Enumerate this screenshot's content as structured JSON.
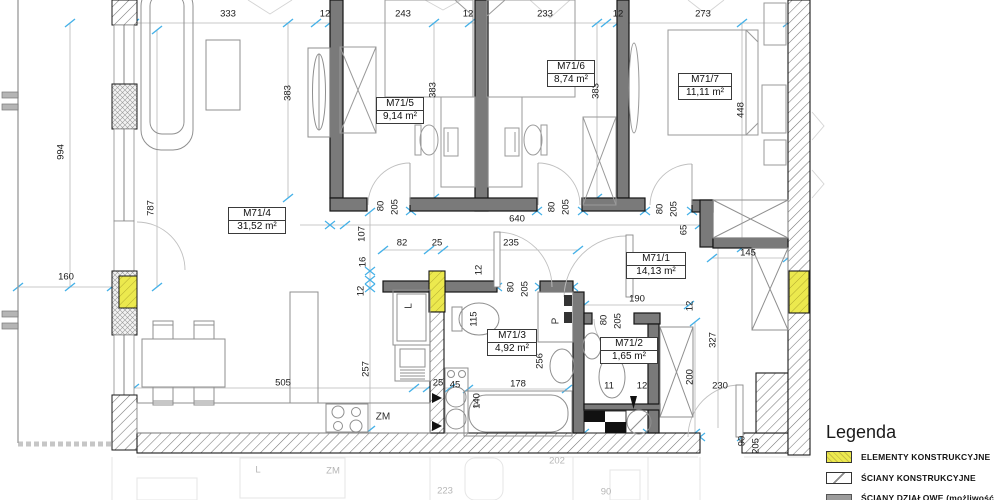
{
  "title": "Rzut mieszkania M71",
  "rooms": [
    {
      "id": "M71/4",
      "area": "31,52 m²"
    },
    {
      "id": "M71/5",
      "area": "9,14 m²"
    },
    {
      "id": "M71/6",
      "area": "8,74 m²"
    },
    {
      "id": "M71/7",
      "area": "11,11 m²"
    },
    {
      "id": "M71/1",
      "area": "14,13 m²"
    },
    {
      "id": "M71/3",
      "area": "4,92 m²"
    },
    {
      "id": "M71/2",
      "area": "1,65 m²"
    }
  ],
  "dims": [
    {
      "t": "333",
      "x": 228,
      "y": 14,
      "r": 0
    },
    {
      "t": "12",
      "x": 325,
      "y": 14,
      "r": 0
    },
    {
      "t": "243",
      "x": 403,
      "y": 14,
      "r": 0
    },
    {
      "t": "12",
      "x": 468,
      "y": 14,
      "r": 0
    },
    {
      "t": "233",
      "x": 545,
      "y": 14,
      "r": 0
    },
    {
      "t": "12",
      "x": 618,
      "y": 14,
      "r": 0
    },
    {
      "t": "273",
      "x": 703,
      "y": 14,
      "r": 0
    },
    {
      "t": "994",
      "x": 61,
      "y": 152,
      "r": 1
    },
    {
      "t": "160",
      "x": 66,
      "y": 277,
      "r": 0
    },
    {
      "t": "787",
      "x": 151,
      "y": 208,
      "r": 1
    },
    {
      "t": "383",
      "x": 288,
      "y": 93,
      "r": 1
    },
    {
      "t": "383",
      "x": 433,
      "y": 90,
      "r": 1
    },
    {
      "t": "383",
      "x": 596,
      "y": 91,
      "r": 1
    },
    {
      "t": "448",
      "x": 741,
      "y": 110,
      "r": 1
    },
    {
      "t": "80",
      "x": 381,
      "y": 206,
      "r": 1
    },
    {
      "t": "205",
      "x": 395,
      "y": 207,
      "r": 1
    },
    {
      "t": "80",
      "x": 552,
      "y": 207,
      "r": 1
    },
    {
      "t": "205",
      "x": 566,
      "y": 207,
      "r": 1
    },
    {
      "t": "80",
      "x": 660,
      "y": 209,
      "r": 1
    },
    {
      "t": "205",
      "x": 674,
      "y": 209,
      "r": 1
    },
    {
      "t": "640",
      "x": 517,
      "y": 219,
      "r": 0
    },
    {
      "t": "65",
      "x": 684,
      "y": 230,
      "r": 1
    },
    {
      "t": "145",
      "x": 748,
      "y": 253,
      "r": 0
    },
    {
      "t": "107",
      "x": 362,
      "y": 234,
      "r": 1
    },
    {
      "t": "16",
      "x": 363,
      "y": 262,
      "r": 1
    },
    {
      "t": "12",
      "x": 361,
      "y": 291,
      "r": 1
    },
    {
      "t": "82",
      "x": 402,
      "y": 243,
      "r": 0
    },
    {
      "t": "25",
      "x": 437,
      "y": 243,
      "r": 0
    },
    {
      "t": "235",
      "x": 511,
      "y": 243,
      "r": 0
    },
    {
      "t": "12",
      "x": 479,
      "y": 270,
      "r": 1
    },
    {
      "t": "80",
      "x": 511,
      "y": 287,
      "r": 1
    },
    {
      "t": "205",
      "x": 525,
      "y": 289,
      "r": 1
    },
    {
      "t": "190",
      "x": 637,
      "y": 299,
      "r": 0
    },
    {
      "t": "80",
      "x": 604,
      "y": 320,
      "r": 1
    },
    {
      "t": "205",
      "x": 618,
      "y": 321,
      "r": 1
    },
    {
      "t": "12",
      "x": 690,
      "y": 306,
      "r": 1
    },
    {
      "t": "327",
      "x": 713,
      "y": 340,
      "r": 1
    },
    {
      "t": "200",
      "x": 690,
      "y": 377,
      "r": 1
    },
    {
      "t": "230",
      "x": 720,
      "y": 386,
      "r": 0
    },
    {
      "t": "257",
      "x": 366,
      "y": 369,
      "r": 1
    },
    {
      "t": "505",
      "x": 283,
      "y": 383,
      "r": 0
    },
    {
      "t": "25",
      "x": 438,
      "y": 383,
      "r": 0
    },
    {
      "t": "45",
      "x": 455,
      "y": 385,
      "r": 0
    },
    {
      "t": "178",
      "x": 518,
      "y": 384,
      "r": 0
    },
    {
      "t": "140",
      "x": 477,
      "y": 401,
      "r": 1
    },
    {
      "t": "115",
      "x": 474,
      "y": 319,
      "r": 1
    },
    {
      "t": "256",
      "x": 540,
      "y": 361,
      "r": 1
    },
    {
      "t": "11",
      "x": 609,
      "y": 386,
      "r": 0
    },
    {
      "t": "12",
      "x": 642,
      "y": 386,
      "r": 0
    },
    {
      "t": "90",
      "x": 742,
      "y": 441,
      "r": 1
    },
    {
      "t": "205",
      "x": 756,
      "y": 446,
      "r": 1
    }
  ],
  "appliances": [
    {
      "t": "L",
      "x": 409,
      "y": 306,
      "r": 1
    },
    {
      "t": "P",
      "x": 556,
      "y": 321,
      "r": 1
    },
    {
      "t": "ZM",
      "x": 383,
      "y": 417,
      "r": 0
    }
  ],
  "ghost_labels": [
    {
      "t": "L",
      "x": 258,
      "y": 470
    },
    {
      "t": "ZM",
      "x": 333,
      "y": 471
    },
    {
      "t": "202",
      "x": 557,
      "y": 461
    },
    {
      "t": "223",
      "x": 445,
      "y": 491
    },
    {
      "t": "90",
      "x": 606,
      "y": 492
    }
  ],
  "legend": {
    "title": "Legenda",
    "items": [
      {
        "label": "ELEMENTY KONSTRUKCYJNE",
        "swatch": "yellow-hatch"
      },
      {
        "label": "ŚCIANY KONSTRUKCYJNE",
        "swatch": "diagonal-hatch"
      },
      {
        "label": "ŚCIANY DZIAŁOWE (możliwość",
        "swatch": "flat-gray"
      }
    ]
  },
  "colors": {
    "structural_yellow": "#ece94e",
    "tick_blue": "#45b1e8",
    "wall_gray": "#7a7a7a",
    "neighbor_hatch": "#777777"
  }
}
